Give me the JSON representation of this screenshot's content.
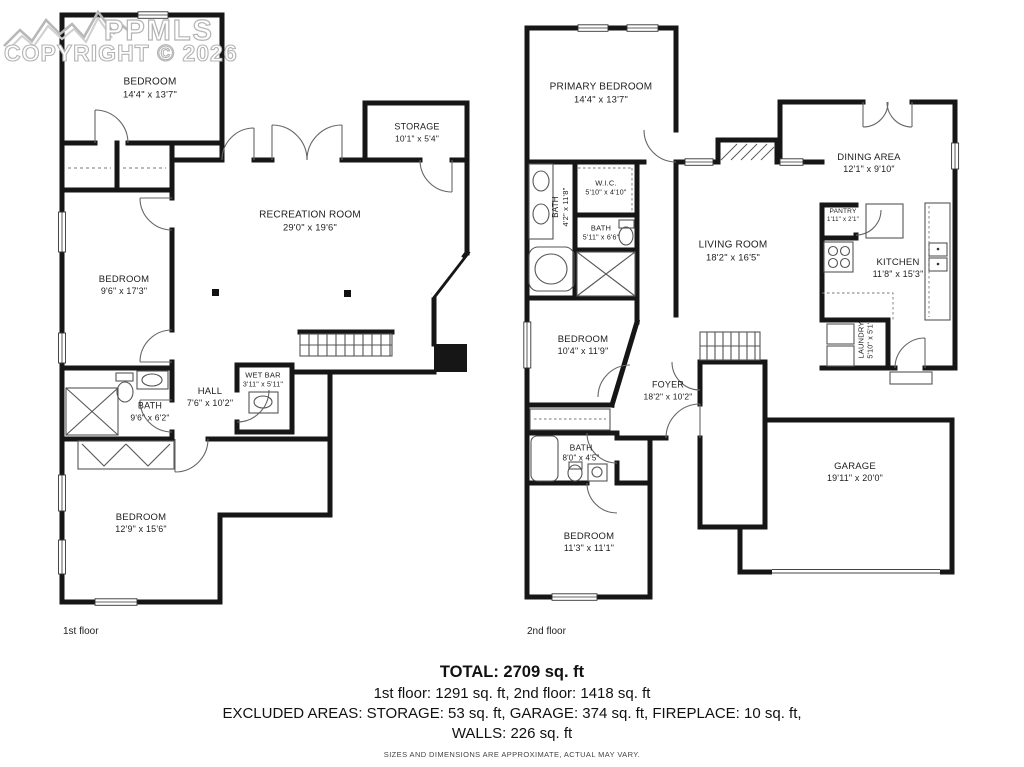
{
  "watermark": {
    "brand": "PPMLS",
    "copyright": "COPYRIGHT © 2026"
  },
  "floors": [
    {
      "label": "1st floor",
      "rooms": [
        {
          "name": "BEDROOM",
          "dims": "14'4\" x 13'7\""
        },
        {
          "name": "STORAGE",
          "dims": "10'1\" x 5'4\""
        },
        {
          "name": "RECREATION ROOM",
          "dims": "29'0\" x 19'6\""
        },
        {
          "name": "BEDROOM",
          "dims": "9'6\" x 17'3\""
        },
        {
          "name": "BATH",
          "dims": "9'6\" x 6'2\""
        },
        {
          "name": "HALL",
          "dims": "7'6\" x 10'2\""
        },
        {
          "name": "WET BAR",
          "dims": "3'11\" x 5'11\""
        },
        {
          "name": "BEDROOM",
          "dims": "12'9\" x 15'6\""
        }
      ]
    },
    {
      "label": "2nd floor",
      "rooms": [
        {
          "name": "PRIMARY BEDROOM",
          "dims": "14'4\" x 13'7\""
        },
        {
          "name": "BATH",
          "dims": "4'2\" x 11'8\""
        },
        {
          "name": "W.I.C.",
          "dims": "5'10\" x 4'10\""
        },
        {
          "name": "BATH",
          "dims": "5'11\" x 6'6\""
        },
        {
          "name": "BEDROOM",
          "dims": "10'4\" x 11'9\""
        },
        {
          "name": "LIVING ROOM",
          "dims": "18'2\" x 16'5\""
        },
        {
          "name": "DINING AREA",
          "dims": "12'1\" x 9'10\""
        },
        {
          "name": "PANTRY",
          "dims": "1'11\" x 2'1\""
        },
        {
          "name": "KITCHEN",
          "dims": "11'8\" x 15'3\""
        },
        {
          "name": "LAUNDRY",
          "dims": "5'10\" x 5'1\""
        },
        {
          "name": "FOYER",
          "dims": "18'2\" x 10'2\""
        },
        {
          "name": "BATH",
          "dims": "8'0\" x 4'5\""
        },
        {
          "name": "BEDROOM",
          "dims": "11'3\" x 11'1\""
        },
        {
          "name": "GARAGE",
          "dims": "19'11\" x 20'0\""
        }
      ]
    }
  ],
  "summary": {
    "total": "TOTAL: 2709 sq. ft",
    "floors_line": "1st floor: 1291 sq. ft, 2nd floor: 1418 sq. ft",
    "excluded_line1": "EXCLUDED AREAS: STORAGE: 53 sq. ft, GARAGE: 374 sq. ft, FIREPLACE: 10 sq. ft,",
    "excluded_line2": "WALLS: 226 sq. ft",
    "disclaimer": "SIZES AND DIMENSIONS ARE APPROXIMATE, ACTUAL MAY VARY."
  }
}
